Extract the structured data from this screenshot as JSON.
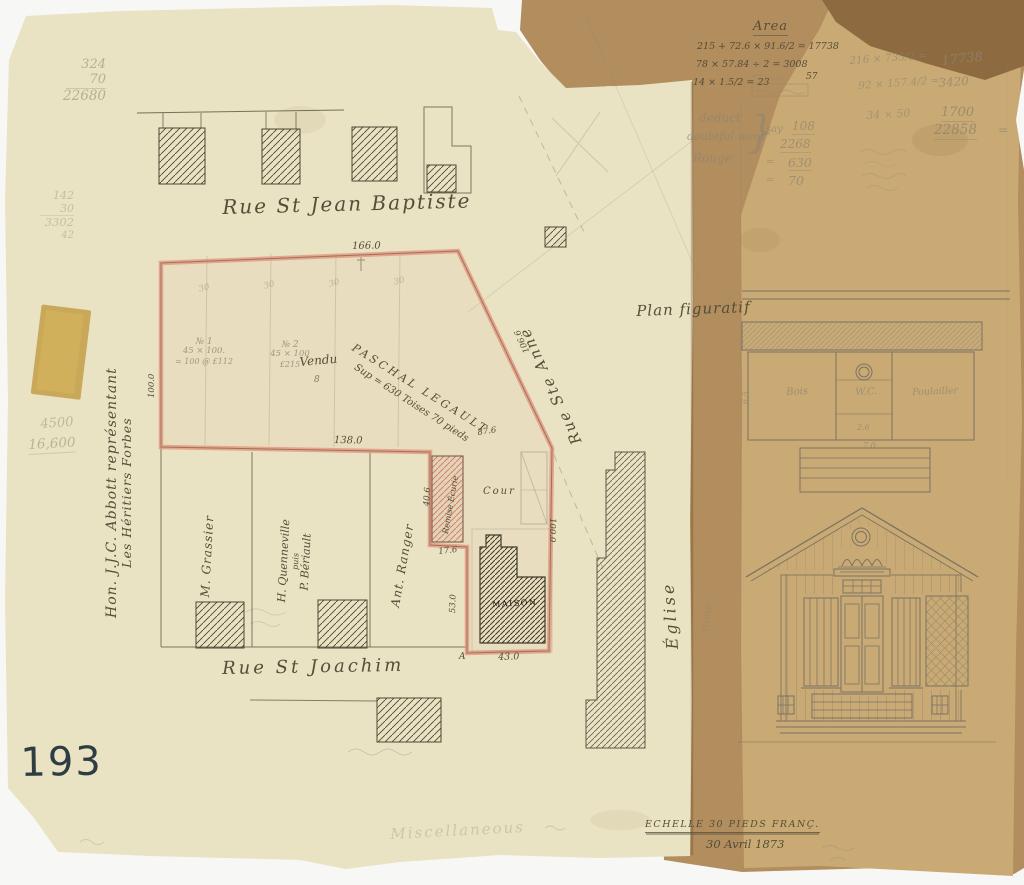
{
  "colors": {
    "paper": "#e9e2c3",
    "backing": "#b28d5e",
    "second_sheet": "#c9aa74",
    "dark_flap": "#8d6a3f",
    "boundary_red": "#e2977f",
    "ink": "#554e38",
    "pencil": "#8d8571",
    "stamp": "#2e3d42"
  },
  "stamp_number": "193",
  "streets": {
    "top": "Rue St Jean Baptiste",
    "bottom": "Rue St Joachim",
    "side": "Rue Ste Anne"
  },
  "titles": {
    "plan": "Plan figuratif",
    "church": "Église",
    "stone": "stone"
  },
  "margin": {
    "line1": "Hon. J.J.C. Abbott représentant",
    "line2": "Les Héritiers Forbes"
  },
  "parcel": {
    "name": "PASCHAL LEGAULT",
    "area": "Sup = 630 Toises 70 pieds",
    "sold": "Vendu",
    "sold_num": "8",
    "lot1": {
      "no": "№ 1",
      "dim": "45 × 100.",
      "price": "= 100 @ £112"
    },
    "lot2": {
      "no": "№ 2",
      "dim": "45 × 100",
      "price": "£215"
    },
    "widths": [
      "30",
      "30",
      "30",
      "30"
    ]
  },
  "neighbors": {
    "lot_a": "M. Grassier",
    "lot_b1": "H. Quenneville",
    "lot_b2": "puis",
    "lot_b3": "P. Bériault",
    "lot_c": "Ant. Ranger"
  },
  "buildings": {
    "stable": "Remise Écurie",
    "house": "MAISON",
    "yard": "Cour",
    "corner": "A"
  },
  "dims": {
    "top": "166.0",
    "left": "100.0",
    "middle": "138.0",
    "diag": "106.6",
    "diag2": "87.6",
    "stable_side": "40.6",
    "stable_base": "17.6",
    "house_side": "53.0",
    "house_base": "43.0",
    "house_right": "100.0"
  },
  "outbuilding": {
    "room1": "Bois",
    "room2": "W.C.",
    "room3": "Poulailler",
    "d1": "2.6",
    "d2": "7.0",
    "d3": "6.5"
  },
  "calc_ink": {
    "title": "Area",
    "l1": "215 + 72.6 × 91.6/2 = 17738",
    "l2": "78 × 57.84 ÷ 2 = 3008",
    "l2b": "57",
    "l3": "14 × 1.5/2 = 23"
  },
  "calc_deduct": {
    "l1": "deduct",
    "l2": "doubtful went",
    "l3": "Rouge",
    "brace": "}",
    "say": "say",
    "n1": "108",
    "n2": "2268",
    "eq": "=",
    "n3": "630",
    "n4": "70"
  },
  "calc_right": {
    "e1": "216 × 735/2 =",
    "r1": "17738",
    "e2": "92 × 157.4/2 =",
    "r2": "3420",
    "e3": "34 × 50",
    "r3": "1700",
    "total": "22858",
    "eq": "="
  },
  "pencil_notes": {
    "m1": "324",
    "m2": "70",
    "m3": "22680",
    "n1": "142",
    "n2": "30",
    "n3": "3302",
    "n4": "42",
    "v1": "4500",
    "v2": "16,600"
  },
  "footer": {
    "scale": "ECHELLE 30 PIEDS FRANÇ.",
    "date": "30 Avril 1873",
    "misc": "Miscellaneous"
  }
}
